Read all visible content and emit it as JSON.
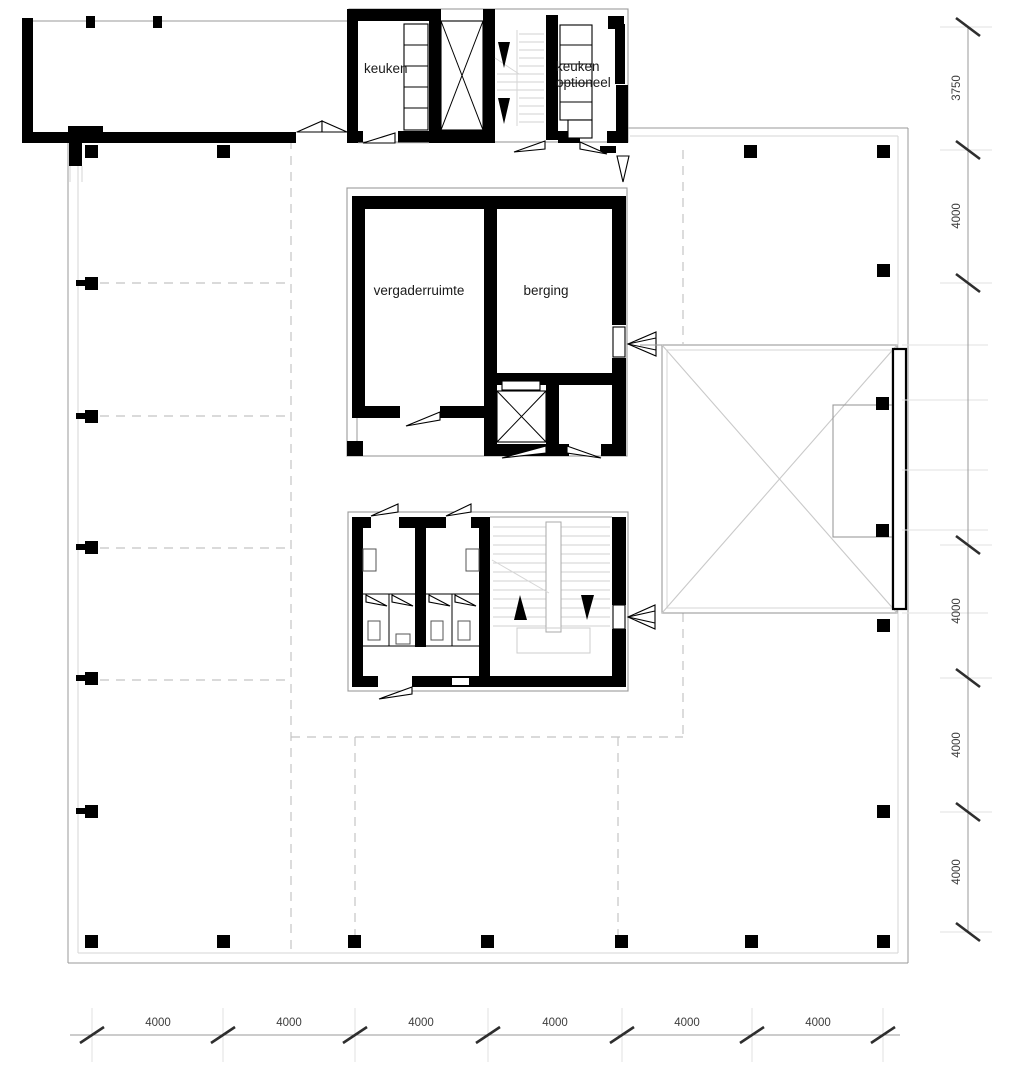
{
  "rooms": {
    "keuken": "keuken",
    "keuken_optioneel": {
      "line1": "keuken",
      "line2": "optioneel"
    },
    "vergaderruimte": "vergaderruimte",
    "berging": "berging"
  },
  "dimensions": {
    "right": [
      "3750",
      "4000",
      "4000",
      "4000",
      "4000"
    ],
    "bottom": [
      "4000",
      "4000",
      "4000",
      "4000",
      "4000",
      "4000"
    ]
  },
  "colors": {
    "wall": "#000000",
    "line": "#999999",
    "dashed": "#c4c4c4",
    "text": "#1a1a1a",
    "dim_text": "#3d3d3d"
  }
}
